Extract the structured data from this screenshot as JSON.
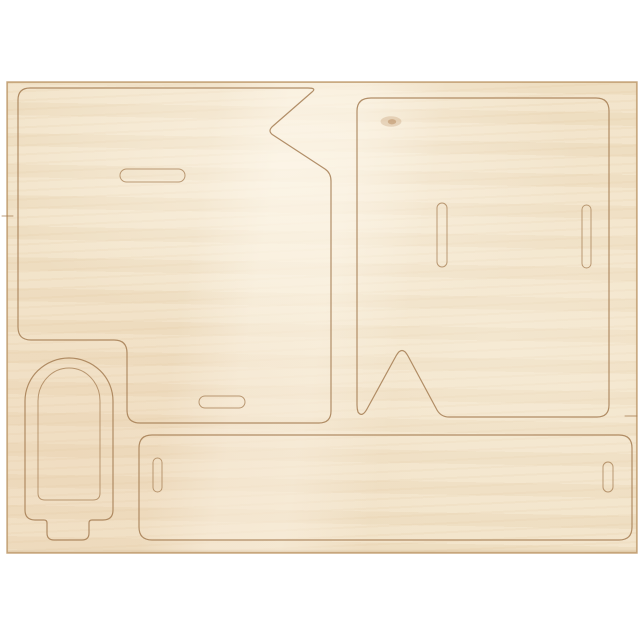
{
  "scene": {
    "type": "product-photo",
    "subject": "plywood craft sheet with laser pre-cut press-out pieces",
    "pieces_visible": 5
  },
  "colors": {
    "bg": "#ffffff",
    "wood-base": "#f1e2c7",
    "cut-line": "#a47c52",
    "sheet-edge": "#c2a073",
    "knot": "#a97040"
  },
  "sheet": {
    "outline_path": "M7,82 L637,82 L637,553 L7,553 Z"
  },
  "pieces": {
    "left_panel": {
      "name": "large left panel with zigzag notch and bottom-left step",
      "path": "M30,88 L308,88 Q317,88 312,92 L273,126 Q267,131 273,135 L325,169 Q331,173 331,181 L331,411 Q331,423 319,423 L140,423 Q127,423 127,410 L127,353 Q127,340 114,340 L31,340 Q18,340 18,327 L18,100 Q18,88 30,88 Z"
    },
    "right_panel": {
      "name": "large right panel with triangular stand notch",
      "path": "M371,98 L596,98 Q609,98 609,111 L609,405 Q609,417 597,417 L449,417 Q441,417 437,410 L408,356 Q402,345 396,356 L367,409 Q362,418 358,412 Q357,409 357,405 L357,111 Q357,98 371,98 Z"
    },
    "bottom_bar": {
      "name": "long bottom bar",
      "path": "M152,435 L619,435 Q632,435 632,448 L632,527 Q632,540 619,540 L152,540 Q139,540 139,527 L139,448 Q139,435 152,435 Z"
    },
    "popsicle_outer": {
      "name": "ice-pop shaped frame outer cut with stick",
      "path": "M25,401 A44,43 0 0 1 113,401 L113,510 Q113,520 103,520 L92,520 Q89,520 89,523 L89,533 Q89,540 82,540 L54,540 Q47,540 47,533 L47,523 Q47,520 44,520 L35,520 Q25,520 25,510 Z"
    },
    "popsicle_inner": {
      "name": "ice-pop inner arch cut",
      "path": "M38,401 A31,33 0 0 1 100,401 L100,493 Q100,500 93,500 L45,500 Q38,500 38,493 Z"
    }
  },
  "slots": {
    "left_panel_top": {
      "name": "horizontal tab slot upper",
      "path": "M126.5,169 L178.5,169 A6.5,6.5 0 0 1 178.5,182 L126.5,182 A6.5,6.5 0 0 1 126.5,169 Z"
    },
    "left_panel_bottom": {
      "name": "horizontal tab slot lower",
      "path": "M205,396 L239,396 A6,6 0 0 1 239,408 L205,408 A6,6 0 0 1 205,396 Z"
    },
    "right_panel_left": {
      "name": "vertical tab slot left",
      "path": "M447,208 L447,262 A5,5 0 0 1 437,262 L437,208 A5,5 0 0 1 447,208 Z"
    },
    "right_panel_right": {
      "name": "vertical tab slot right",
      "path": "M591,209.5 L591,263.5 A4.5,4.5 0 0 1 582,263.5 L582,209.5 A4.5,4.5 0 0 1 591,209.5 Z"
    },
    "bottom_bar_left": {
      "name": "vertical tab slot in bar left end",
      "path": "M162,462.5 L162,487.5 A4.5,4.5 0 0 1 153,487.5 L153,462.5 A4.5,4.5 0 0 1 162,462.5 Z"
    },
    "bottom_bar_right": {
      "name": "vertical tab slot in bar right end",
      "path": "M613,467 L613,487 A5,5 0 0 1 603,487 L603,467 A5,5 0 0 1 613,467 Z"
    }
  },
  "marks": {
    "edge_tick_right": {
      "name": "cut lead-in at right sheet edge",
      "path": "M625,416 L637,416"
    },
    "edge_tick_left": {
      "name": "cut lead-in at left sheet edge",
      "path": "M2,216 L13,216"
    },
    "knot_outer": {
      "name": "wood knot halo",
      "path": "M381,120 a10,5 0 1 0 20,3 a10,5 0 1 0 -20,-3 Z"
    },
    "knot_core": {
      "name": "wood knot core",
      "path": "M388,121 a4,2.5 0 1 0 8,1.5 a4,2.5 0 1 0 -8,-1.5 Z"
    }
  }
}
